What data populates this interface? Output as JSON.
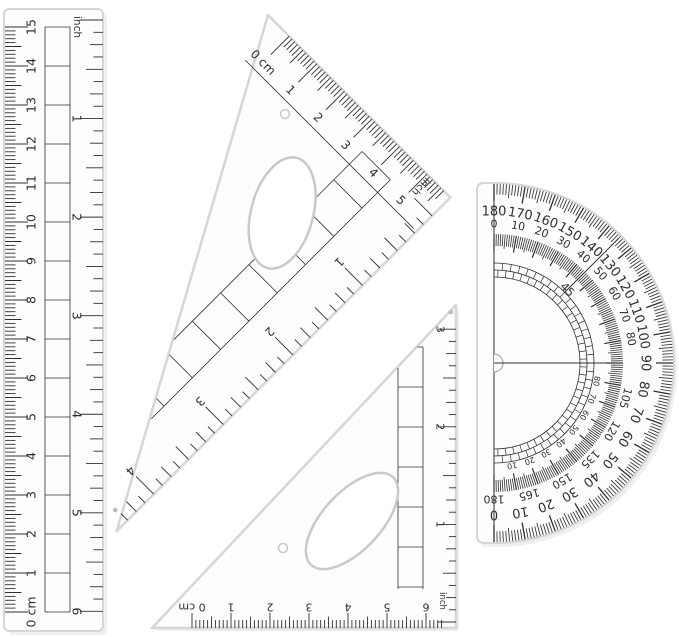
{
  "colors": {
    "background": "#ffffff",
    "ink": "#2f2f2f",
    "plastic_edge": "#d6d6d6",
    "plastic_fill": "#fdfdfd",
    "shadow": "#efefef",
    "hole_edge": "#c9c9c9",
    "mold_dot": "#bdbdbd"
  },
  "ruler": {
    "cm_scale": {
      "numbers": [
        "0 cm",
        "1",
        "2",
        "3",
        "4",
        "5",
        "6",
        "7",
        "8",
        "9",
        "10",
        "11",
        "12",
        "13",
        "14",
        "15"
      ]
    },
    "inch_scale": {
      "label": "inch",
      "numbers": [
        "1",
        "2",
        "3",
        "4",
        "5",
        "6"
      ]
    }
  },
  "large_triangle": {
    "cm_scale": {
      "numbers": [
        "0 cm",
        "1",
        "2",
        "3",
        "4",
        "5"
      ]
    },
    "inch_scale": {
      "label": "inch",
      "numbers": [
        "1",
        "2",
        "3",
        "4"
      ]
    }
  },
  "small_triangle": {
    "cm_scale": {
      "numbers": [
        "0 cm",
        "1",
        "2",
        "3",
        "4",
        "5",
        "6"
      ]
    },
    "inch_scale": {
      "label": "inch",
      "numbers": [
        "1",
        "2",
        "3"
      ]
    }
  },
  "protractor": {
    "outer_scale": [
      "180",
      "170",
      "160",
      "150",
      "140",
      "130",
      "120",
      "110",
      "100",
      "90",
      "80",
      "70",
      "60",
      "50",
      "40",
      "30",
      "20",
      "10",
      "0"
    ],
    "inner_scale_upper": [
      "0",
      "10",
      "20",
      "30",
      "40",
      "50",
      "60",
      "70",
      "80"
    ],
    "inner_scale_lower": [
      "105",
      "120",
      "135",
      "150",
      "165",
      "180"
    ],
    "quadrant_label": "45",
    "reversed_scale": [
      "10",
      "20",
      "30",
      "40",
      "50",
      "60",
      "70",
      "80"
    ]
  }
}
